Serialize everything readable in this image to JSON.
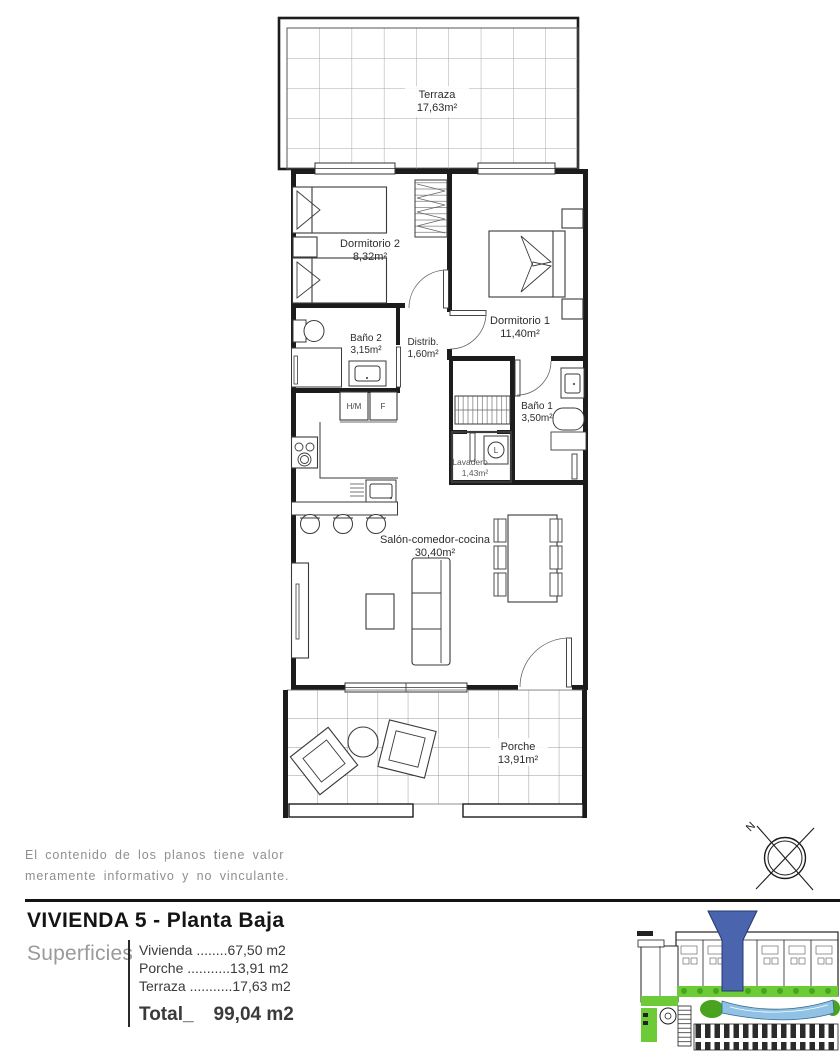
{
  "rooms": {
    "terraza": {
      "name": "Terraza",
      "area": "17,63m²"
    },
    "dormitorio2": {
      "name": "Dormitorio 2",
      "area": "8,32m²"
    },
    "dormitorio1": {
      "name": "Dormitorio 1",
      "area": "11,40m²"
    },
    "bano2": {
      "name": "Baño 2",
      "area": "3,15m²"
    },
    "distribuidor": {
      "name": "Distrib.",
      "area": "1,60m²"
    },
    "bano1": {
      "name": "Baño 1",
      "area": "3,50m²"
    },
    "lavadero": {
      "name": "Lavadero",
      "area": "1,43m²"
    },
    "salon": {
      "name": "Salón-comedor-cocina",
      "area": "30,40m²"
    },
    "porche": {
      "name": "Porche",
      "area": "13,91m²"
    }
  },
  "appliance_labels": {
    "washer_dryer": "H/M",
    "fridge": "F",
    "laundry_machine": "L"
  },
  "compass": {
    "north": "N"
  },
  "disclaimer": {
    "line1": "El contenido de los planos tiene valor",
    "line2": "meramente informativo y no vinculante."
  },
  "title_block": {
    "title": "VIVIENDA 5 - Planta Baja",
    "superficies_label": "Superficies",
    "surfaces": [
      {
        "label": "Vivienda",
        "dots": "........",
        "value": "67,50 m2"
      },
      {
        "label": "Porche",
        "dots": "...........",
        "value": "13,91 m2"
      },
      {
        "label": "Terraza",
        "dots": "...........",
        "value": "17,63 m2"
      }
    ],
    "total_label": "Total_",
    "total_value": "99,04 m2"
  },
  "colors": {
    "wall_black": "#1c1c1c",
    "grid_grey": "#a3a3a3",
    "muted_text": "#8f8f8f",
    "marker_blue": "#4a64ae",
    "site_green": "#6ecb38",
    "site_green_dark": "#49a31e",
    "pool_blue": "#8fc2e4"
  }
}
